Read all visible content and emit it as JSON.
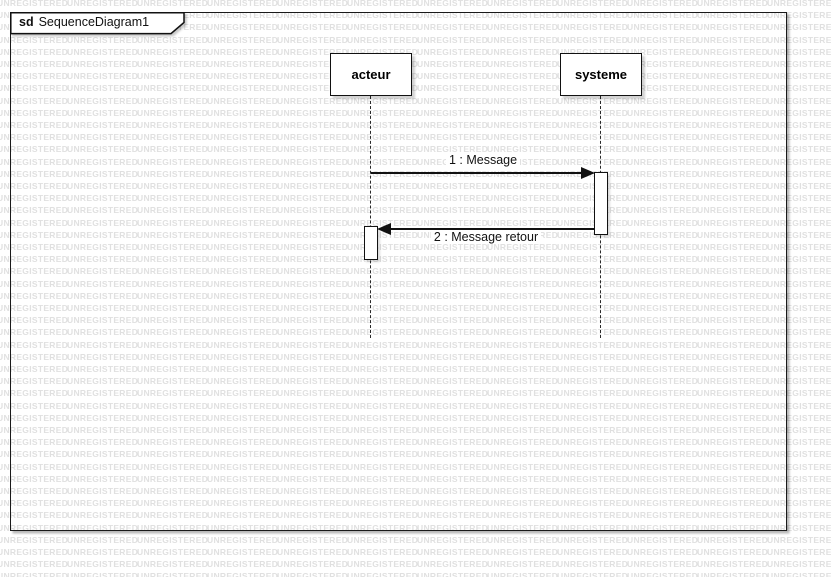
{
  "watermark": {
    "text": "UNREGISTERED",
    "color": "#e0e0e0"
  },
  "diagram": {
    "frame_keyword": "sd",
    "frame_title": "SequenceDiagram1",
    "lifelines": [
      {
        "name": "acteur"
      },
      {
        "name": "systeme"
      }
    ],
    "messages": [
      {
        "label": "1 : Message"
      },
      {
        "label": "2 : Message retour"
      }
    ]
  },
  "colors": {
    "stroke": "#111111",
    "fill": "#ffffff",
    "watermark": "#e0e0e0"
  }
}
